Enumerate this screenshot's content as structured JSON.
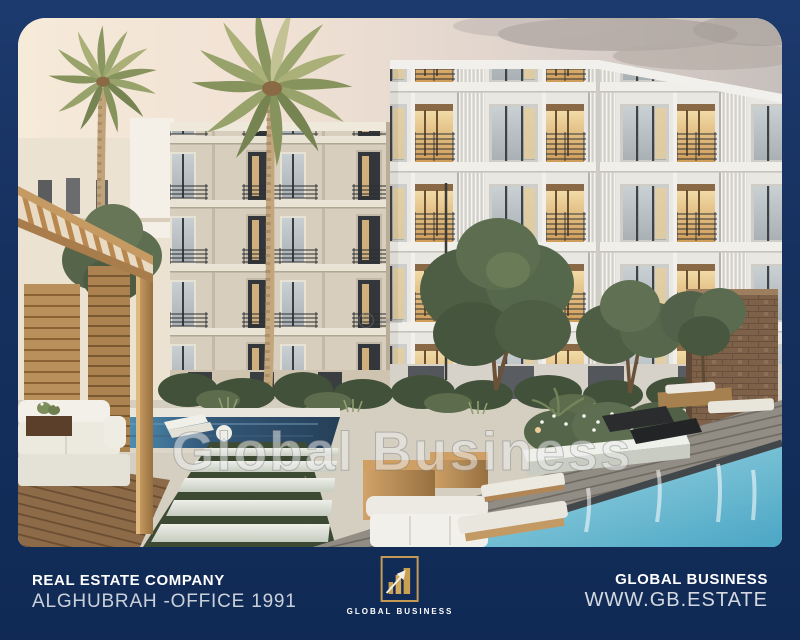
{
  "photo": {
    "watermark": "Global Business",
    "copyright_mark": "©"
  },
  "footer": {
    "left": {
      "line1": "REAL ESTATE COMPANY",
      "line2": "ALGHUBRAH -OFFICE 1991"
    },
    "logo": {
      "label": "GLOBAL BUSINESS"
    },
    "right": {
      "line1": "GLOBAL BUSINESS",
      "line2": "WWW.GB.ESTATE"
    }
  },
  "colors": {
    "frame_navy": "#16315f",
    "gold": "#c49a55",
    "pool_teal": "#5fb4cb",
    "pool_dark": "#2a4964",
    "watermark_white": "rgba(255,255,255,0.55)"
  }
}
